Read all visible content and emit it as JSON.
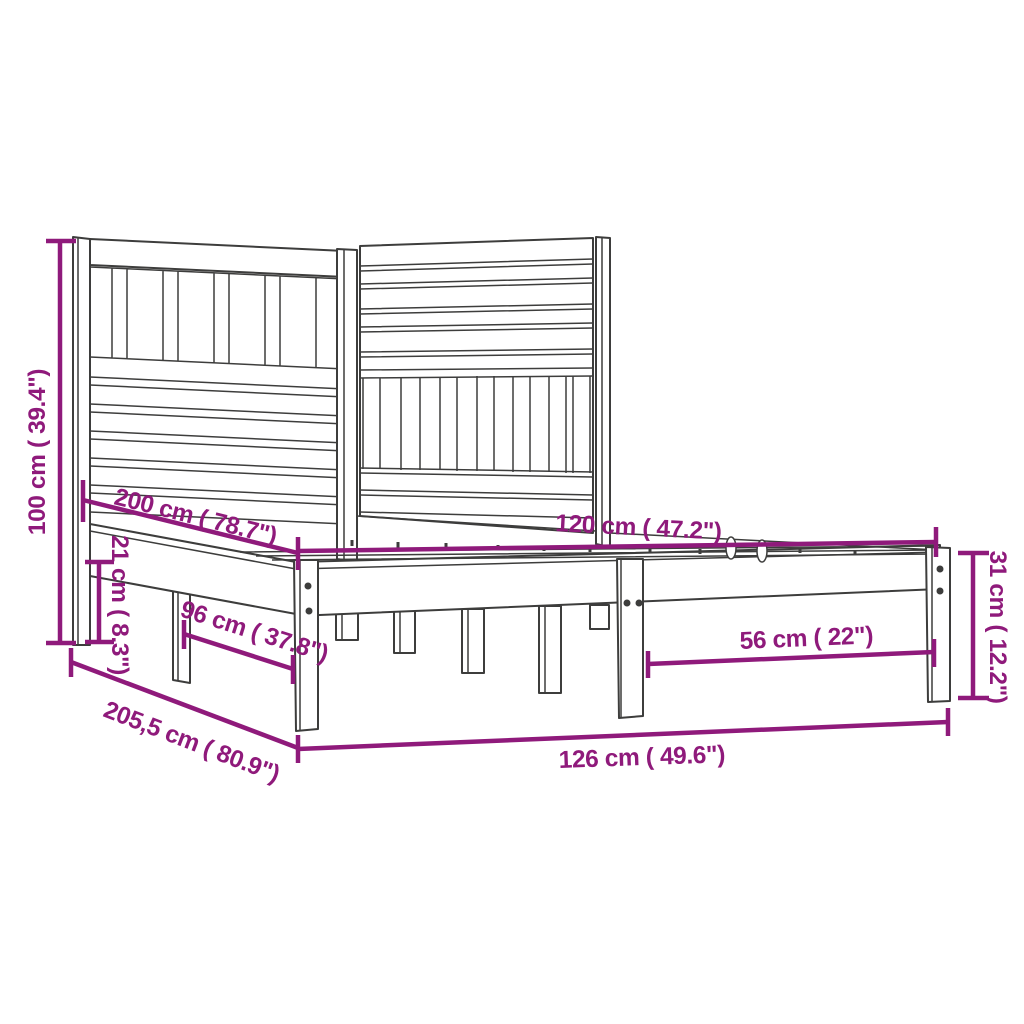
{
  "diagram": {
    "type": "product-dimension-diagram",
    "subject": "bed frame with headboard",
    "units": [
      "cm",
      "inch"
    ],
    "colors": {
      "dimension": "#8F1A7B",
      "artwork": "#3D3D3C",
      "background": "#FFFFFF"
    },
    "dims": {
      "d100": {
        "label": "100 cm ( 39.4\")",
        "orientation": "vertical-left"
      },
      "d200": {
        "label": "200 cm ( 78.7\")",
        "orientation": "diagonal"
      },
      "d120": {
        "label": "120 cm ( 47.2\")",
        "orientation": "horizontal"
      },
      "d21": {
        "label": "21 cm ( 8.3\")",
        "orientation": "vertical"
      },
      "d96": {
        "label": "96 cm ( 37.8\")",
        "orientation": "diagonal"
      },
      "d2055": {
        "label": "205,5 cm ( 80.9\")",
        "orientation": "diagonal"
      },
      "d126": {
        "label": "126 cm ( 49.6\")",
        "orientation": "horizontal"
      },
      "d56": {
        "label": "56 cm ( 22\")",
        "orientation": "horizontal"
      },
      "d31": {
        "label": "31 cm ( 12.2\")",
        "orientation": "vertical-right"
      }
    }
  }
}
